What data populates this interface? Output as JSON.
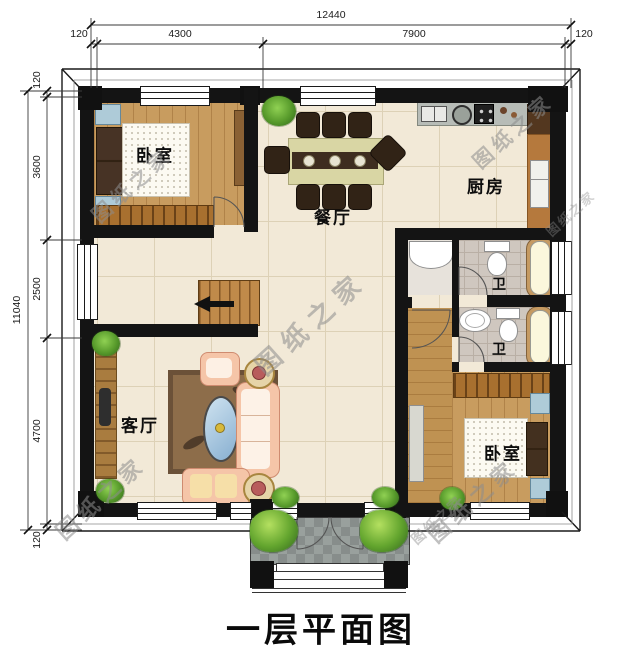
{
  "title": "一层平面图",
  "watermark_text": "图纸之家",
  "rooms": {
    "bedroom_top": "卧室",
    "dining": "餐厅",
    "kitchen": "厨房",
    "bath_upper": "卫",
    "bath_lower": "卫",
    "living": "客厅",
    "bedroom_bottom": "卧室"
  },
  "dimensions": {
    "top": {
      "overall": "12440",
      "segments": [
        "120",
        "4300",
        "7900",
        "120"
      ]
    },
    "left": {
      "overall": "11040",
      "segments": [
        "120",
        "3600",
        "2500",
        "4700",
        "120"
      ]
    }
  },
  "colors": {
    "wall": "#141414",
    "floor_tile": "#f2e9d7",
    "wood": "#c89c5f",
    "porch": "#8f9593",
    "accent_sofa": "#f5c5a8"
  }
}
